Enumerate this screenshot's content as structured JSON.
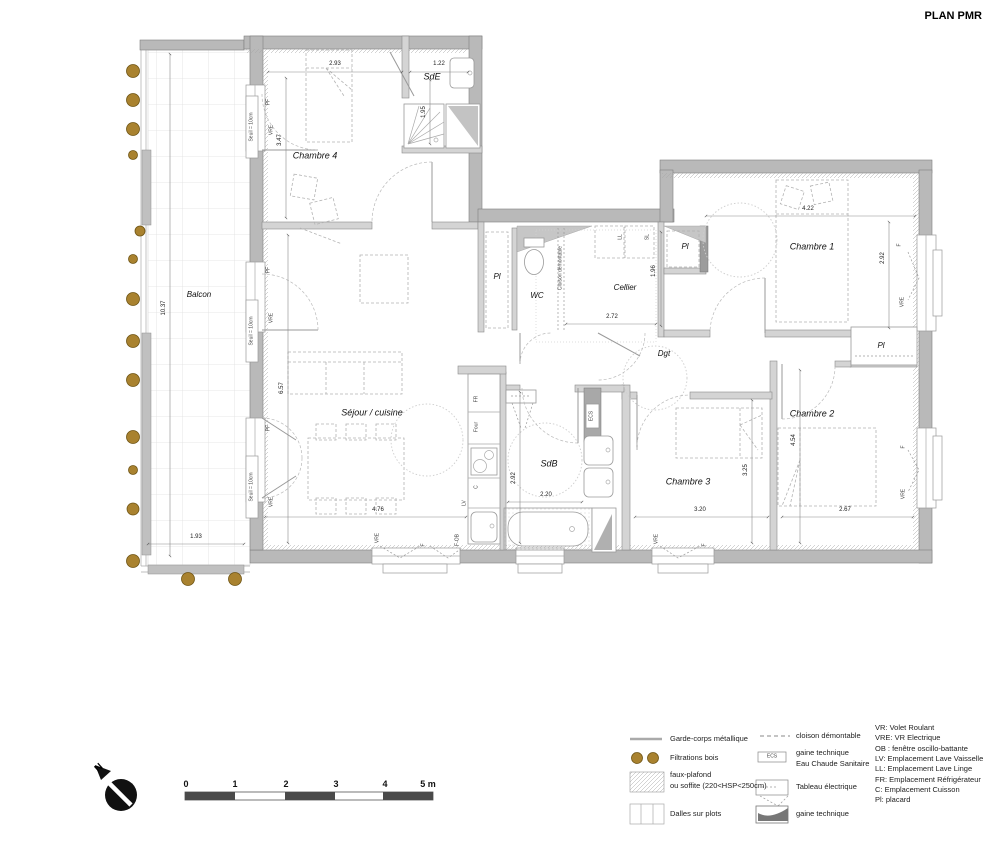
{
  "title": "PLAN PMR",
  "plan": {
    "rooms": {
      "balcon": "Balcon",
      "chambre4": "Chambre 4",
      "sde": "SdE",
      "wc": "WC",
      "cellier": "Cellier",
      "pl": "Pl",
      "chambre1": "Chambre 1",
      "dgt": "Dgt",
      "sejour": "Séjour / cuisine",
      "sdb": "SdB",
      "chambre3": "Chambre 3",
      "chambre2": "Chambre 2"
    },
    "dims": {
      "balcon_w": "1.93",
      "balcon_h": "10.37",
      "c4_w": "2.93",
      "c4_h": "3.47",
      "sde_w": "1.22",
      "sde_h": "1.95",
      "cellier_w": "2.72",
      "cellier_h": "1.96",
      "c1_w": "4.22",
      "c1_h": "2.92",
      "c2_w": "2.67",
      "c2_h": "4.54",
      "c3_w": "3.20",
      "c3_h": "3.25",
      "sdb_w": "2.20",
      "sdb_h": "2.92",
      "sejour_w": "4.76",
      "sejour_h": "6.57"
    },
    "labels": {
      "seuil": "Seuil = 10cm",
      "pf": "PF",
      "vre": "VRE",
      "f": "F",
      "f_ob": "F-OB",
      "fr": "FR",
      "four": "Four",
      "c": "C",
      "lv": "LV",
      "ll": "LL",
      "sl": "SL",
      "ecs": "ECS",
      "cloison": "Cloison démontable"
    }
  },
  "legend": {
    "left": [
      {
        "label": "Garde-corps métallique"
      },
      {
        "label": "Filtrations bois"
      },
      {
        "label": "faux-plafond",
        "label2": "ou soffite (220<HSP<250cm)"
      },
      {
        "label": "Dalles sur plots"
      }
    ],
    "right": [
      {
        "label": "cloison démontable"
      },
      {
        "label": "gaine technique",
        "label2": "Eau Chaude Sanitaire"
      },
      {
        "label": "Tableau électrique"
      },
      {
        "label": "gaine technique"
      }
    ],
    "ecs_box": "ECS",
    "abbreviations": [
      "VR: Volet Roulant",
      "VRE: VR Electrique",
      "OB : fenêtre oscillo-battante",
      "LV: Emplacement Lave Vaisselle",
      "LL: Emplacement Lave Linge",
      "FR: Emplacement Réfrigérateur",
      "C: Emplacement Cuisson",
      "Pl: placard"
    ]
  },
  "scale": {
    "labels": [
      "0",
      "1",
      "2",
      "3",
      "4",
      "5 m"
    ]
  },
  "north": {
    "label": "N"
  },
  "colors": {
    "wood": "#a9822f",
    "wall": "#b9b9b9"
  }
}
